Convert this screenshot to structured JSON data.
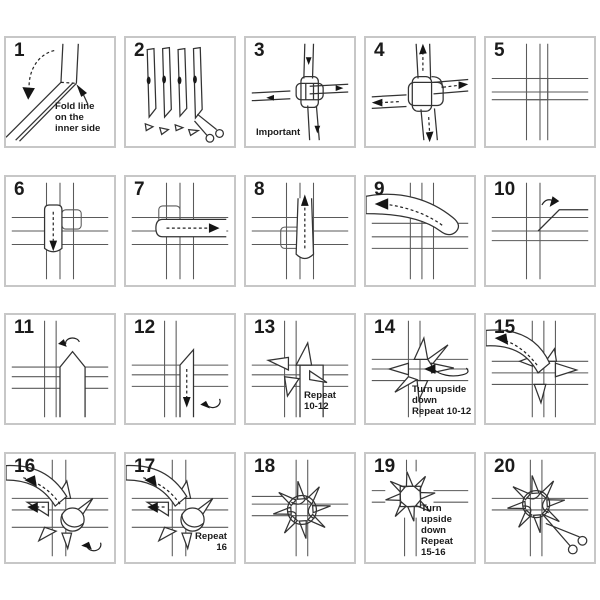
{
  "figure": {
    "type": "step-by-step instruction diagram",
    "steps_total": 20,
    "background": "#ffffff",
    "panel_border_color": "#c7c7c7",
    "line_color": "#3a3a3a",
    "text_color": "#1b1b1b"
  },
  "panels": [
    {
      "number": "1",
      "caption": "Fold line\non the\ninner side",
      "icons": [
        "fold-direction-dashed-arrow",
        "pointer-arrow"
      ]
    },
    {
      "number": "2",
      "caption": "",
      "icons": [
        "scissors-icon"
      ]
    },
    {
      "number": "3",
      "caption": "Important",
      "icons": [
        "pull-direction-arrows"
      ]
    },
    {
      "number": "4",
      "caption": "",
      "icons": [
        "pull-outward-dashed-arrows"
      ]
    },
    {
      "number": "5",
      "caption": "",
      "icons": []
    },
    {
      "number": "6",
      "caption": "",
      "icons": [
        "fold-down-dashed-arrow"
      ]
    },
    {
      "number": "7",
      "caption": "",
      "icons": [
        "fold-right-dashed-arrow"
      ]
    },
    {
      "number": "8",
      "caption": "",
      "icons": [
        "fold-up-dashed-arrow"
      ]
    },
    {
      "number": "9",
      "caption": "",
      "icons": [
        "fold-left-dashed-arrow"
      ]
    },
    {
      "number": "10",
      "caption": "",
      "icons": [
        "rotate-arrow"
      ]
    },
    {
      "number": "11",
      "caption": "",
      "icons": [
        "rotate-arrow"
      ]
    },
    {
      "number": "12",
      "caption": "",
      "icons": [
        "fold-down-dashed-arrow",
        "rotate-arrow"
      ]
    },
    {
      "number": "13",
      "caption": "Repeat\n10-12",
      "icons": []
    },
    {
      "number": "14",
      "caption": "Turn upside\ndown\nRepeat 10-12",
      "icons": [
        "turn-over-arrow"
      ]
    },
    {
      "number": "15",
      "caption": "",
      "icons": [
        "fold-dashed-arrow"
      ]
    },
    {
      "number": "16",
      "caption": "",
      "icons": [
        "fold-left-dashed-arrow",
        "rotate-arrow"
      ]
    },
    {
      "number": "17",
      "caption": "Repeat\n16",
      "icons": [
        "fold-left-dashed-arrow"
      ]
    },
    {
      "number": "18",
      "caption": "",
      "icons": []
    },
    {
      "number": "19",
      "caption": "Turn upside\ndown\nRepeat\n15-16",
      "icons": []
    },
    {
      "number": "20",
      "caption": "",
      "icons": [
        "scissors-icon"
      ]
    }
  ]
}
